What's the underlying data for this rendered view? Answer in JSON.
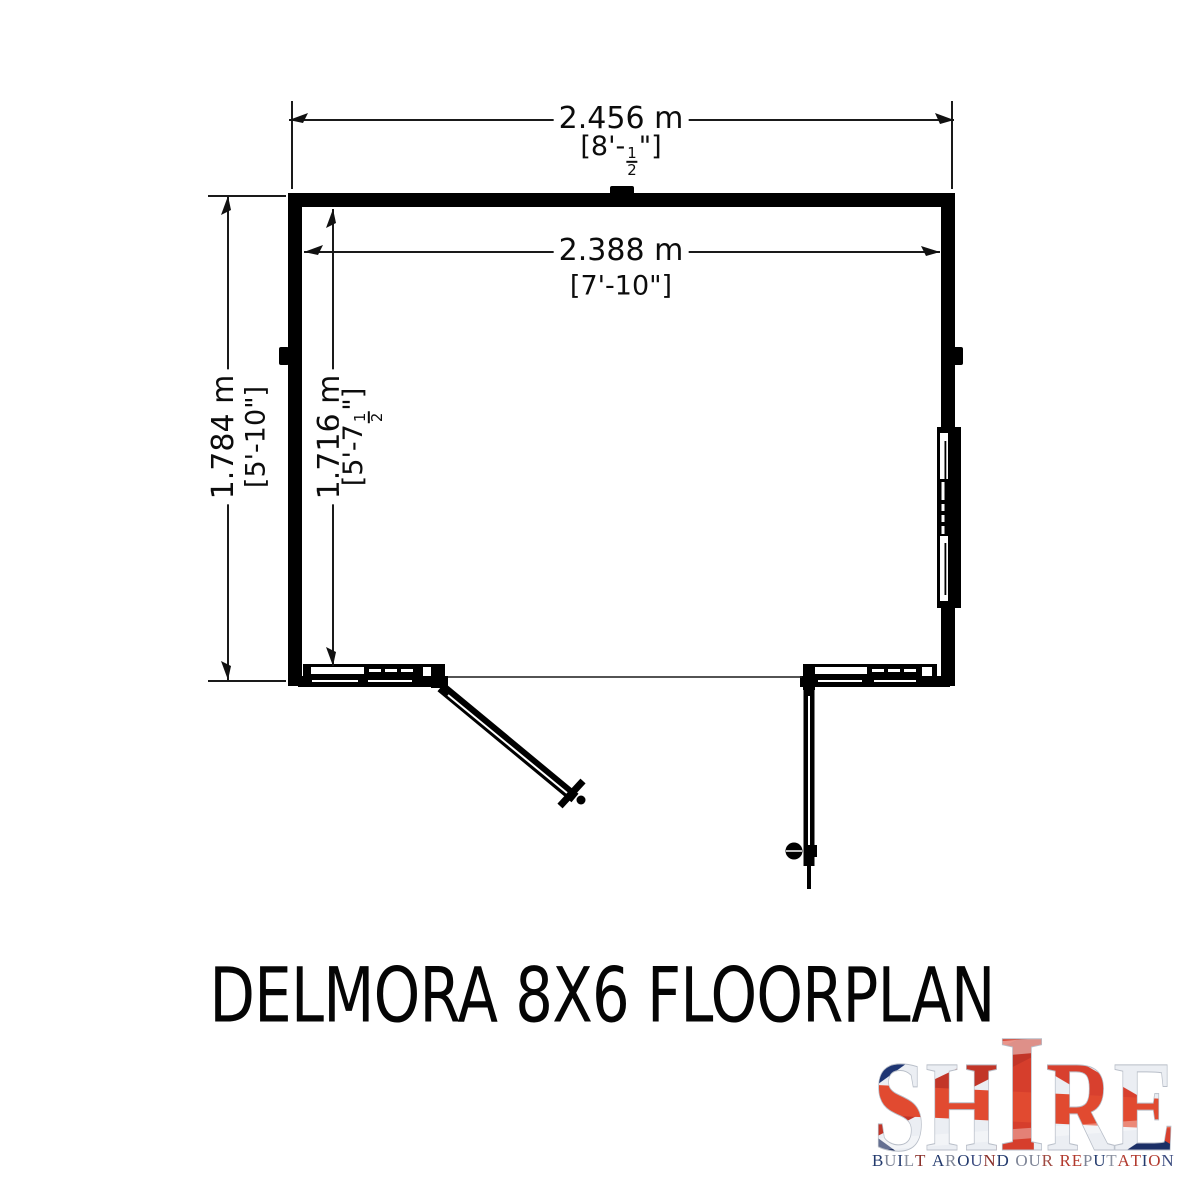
{
  "title": "DELMORA 8X6 FLOORPLAN",
  "floorplan": {
    "dim_width_outer": {
      "metric": "2.456 m",
      "imp_prefix": "[8'-",
      "frac_num": "1",
      "frac_den": "2",
      "imp_suffix": "\"]"
    },
    "dim_width_inner": {
      "metric": "2.388 m",
      "imperial": "[7'-10\"]"
    },
    "dim_depth_outer": {
      "metric": "1.784 m",
      "imperial": "[5'-10\"]"
    },
    "dim_depth_inner": {
      "metric": "1.716 m",
      "imp_prefix": "[5'-7",
      "frac_num": "1",
      "frac_den": "2",
      "imp_suffix": "\"]"
    }
  },
  "logo": {
    "brand": "SHIRE",
    "brand_parts": {
      "left": "SH",
      "tall": "I",
      "right": "RE"
    },
    "tagline": "BUILT AROUND OUR REPUTATION",
    "tagline_letters": [
      {
        "c": "B",
        "col": "#233a6d"
      },
      {
        "c": "U",
        "col": "#7d8496"
      },
      {
        "c": "I",
        "col": "#233a6d"
      },
      {
        "c": "L",
        "col": "#8a91a0"
      },
      {
        "c": "T",
        "col": "#8a2f2a"
      },
      {
        "c": " "
      },
      {
        "c": "A",
        "col": "#233a6d"
      },
      {
        "c": "R",
        "col": "#7d8496"
      },
      {
        "c": "O",
        "col": "#233a6d"
      },
      {
        "c": "U",
        "col": "#3c4c80"
      },
      {
        "c": "N",
        "col": "#8a2f2a"
      },
      {
        "c": "D",
        "col": "#233a6d"
      },
      {
        "c": " "
      },
      {
        "c": "O",
        "col": "#7d8496"
      },
      {
        "c": "U",
        "col": "#7d8496"
      },
      {
        "c": "R",
        "col": "#a04a42"
      },
      {
        "c": " "
      },
      {
        "c": "R",
        "col": "#b23a2e"
      },
      {
        "c": "E",
        "col": "#b23a2e"
      },
      {
        "c": "P",
        "col": "#7d8496"
      },
      {
        "c": "U",
        "col": "#233a6d"
      },
      {
        "c": "T",
        "col": "#8a91a0"
      },
      {
        "c": "A",
        "col": "#b23a2e"
      },
      {
        "c": "T",
        "col": "#b23a2e"
      },
      {
        "c": "I",
        "col": "#233a6d"
      },
      {
        "c": "O",
        "col": "#b23a2e"
      },
      {
        "c": "N",
        "col": "#3c4c80"
      }
    ],
    "flag_colors": {
      "navy": "#1e3572",
      "navy_dark": "#132457",
      "red": "#d8402e",
      "red_bright": "#e14a30",
      "silver": "#ebeef3"
    }
  },
  "colors": {
    "ink": "#000000",
    "dim_line": "#1a1a1a",
    "background": "#ffffff"
  }
}
